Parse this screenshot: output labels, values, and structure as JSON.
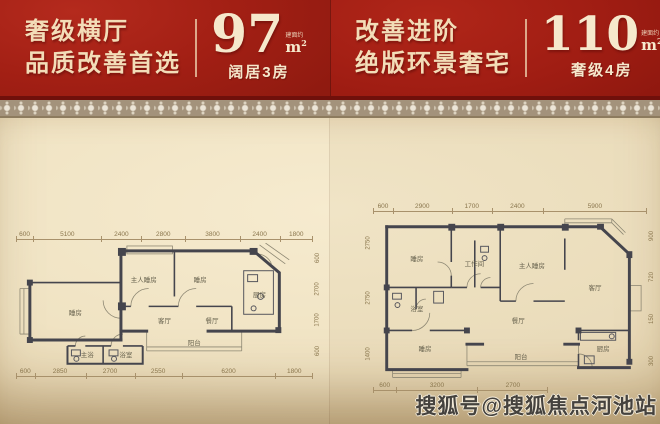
{
  "banners": [
    {
      "headline_line1": "奢级横厅",
      "headline_line2": "品质改善首选",
      "area_number": "97",
      "area_note": "建面约",
      "area_unit_m": "m",
      "area_unit_sup": "2",
      "subtitle": "阔居3房"
    },
    {
      "headline_line1": "改善进阶",
      "headline_line2": "绝版环景奢宅",
      "area_number": "110",
      "area_note": "建面约",
      "area_unit_m": "m",
      "area_unit_sup": "2",
      "subtitle": "奢级4房"
    }
  ],
  "plans": [
    {
      "top_dims": [
        "600",
        "5100",
        "2400",
        "2800",
        "3800",
        "2400",
        "1800"
      ],
      "bottom_dims": [
        "600",
        "2850",
        "2700",
        "2550",
        "6200",
        "1800"
      ],
      "right_dims": [
        "600",
        "2700",
        "1700",
        "600"
      ],
      "rooms": [
        {
          "label": "睡房",
          "x": 20,
          "y": 56
        },
        {
          "label": "主人睡房",
          "x": 43,
          "y": 29
        },
        {
          "label": "睡房",
          "x": 62,
          "y": 29
        },
        {
          "label": "客厅",
          "x": 50,
          "y": 62
        },
        {
          "label": "餐厅",
          "x": 66,
          "y": 62
        },
        {
          "label": "厨房",
          "x": 82,
          "y": 41
        },
        {
          "label": "主浴",
          "x": 24,
          "y": 90
        },
        {
          "label": "浴室",
          "x": 37,
          "y": 90
        },
        {
          "label": "阳台",
          "x": 60,
          "y": 80
        }
      ]
    },
    {
      "top_dims": [
        "600",
        "2900",
        "1700",
        "2400",
        "5900"
      ],
      "bottom_dims": [
        "600",
        "3200",
        "2700"
      ],
      "left_dims": [
        "2750",
        "2750",
        "1400"
      ],
      "right_dims": [
        "900",
        "720",
        "150",
        "300"
      ],
      "rooms": [
        {
          "label": "睡房",
          "x": 16,
          "y": 26
        },
        {
          "label": "浴室",
          "x": 16,
          "y": 56
        },
        {
          "label": "工作间",
          "x": 37,
          "y": 29
        },
        {
          "label": "主人睡房",
          "x": 58,
          "y": 30
        },
        {
          "label": "客厅",
          "x": 81,
          "y": 43
        },
        {
          "label": "餐厅",
          "x": 53,
          "y": 63
        },
        {
          "label": "睡房",
          "x": 19,
          "y": 80
        },
        {
          "label": "阳台",
          "x": 54,
          "y": 85
        },
        {
          "label": "厨房",
          "x": 84,
          "y": 80
        }
      ]
    }
  ],
  "watermark": "搜狐号@搜狐焦点河池站",
  "colors": {
    "banner_red": "#a21f14",
    "cream_text": "#f3ddb8",
    "background_beige": "#f0e3c3",
    "wall": "#45454d",
    "dim_text": "#8a764d"
  }
}
